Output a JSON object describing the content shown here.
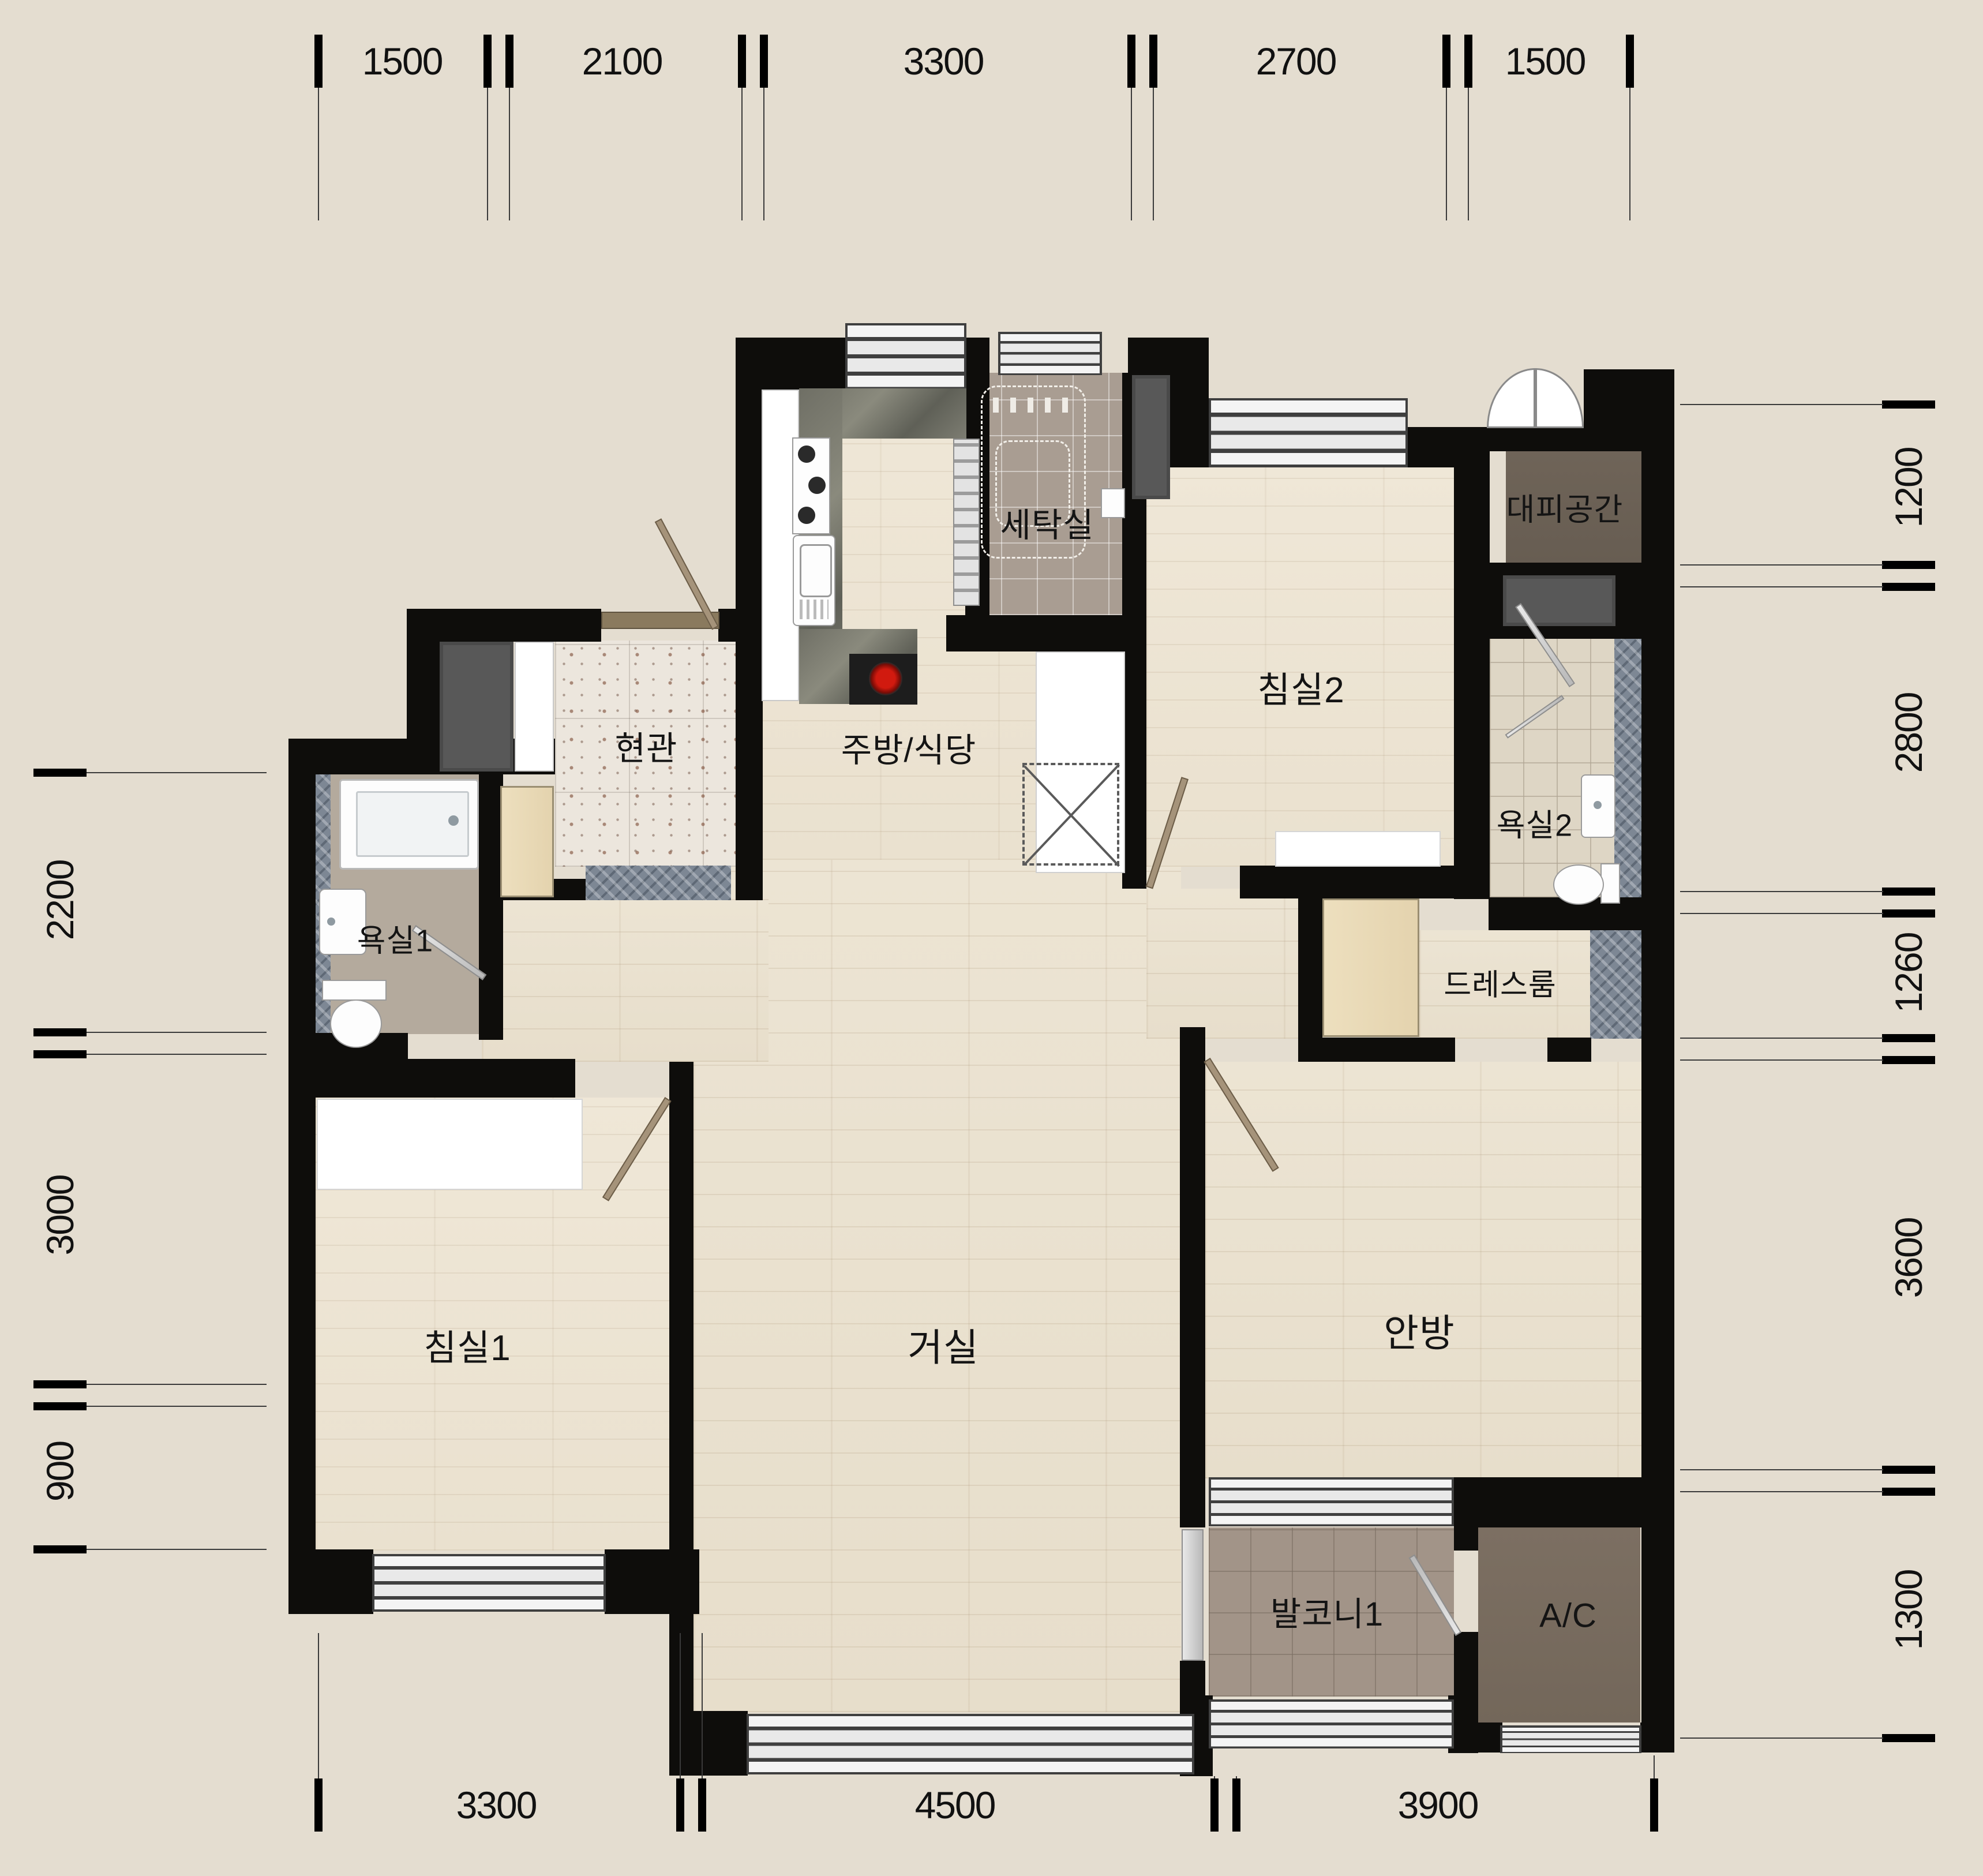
{
  "plan": {
    "type": "korean-apartment-floor-plan",
    "rooms": {
      "laundry": "세탁실",
      "shelter": "대피공간",
      "bedroom2": "침실2",
      "bath2": "욕실2",
      "entrance": "현관",
      "kitchen": "주방/식당",
      "bath1": "욕실1",
      "dressroom": "드레스룸",
      "bedroom1": "침실1",
      "living": "거실",
      "master": "안방",
      "balcony1": "발코니1",
      "ac": "A/C"
    },
    "dimensions": {
      "top": [
        "1500",
        "2100",
        "3300",
        "2700",
        "1500"
      ],
      "right": [
        "1200",
        "2800",
        "1260",
        "3600",
        "1300"
      ],
      "left": [
        "2200",
        "3000",
        "900"
      ],
      "bottom": [
        "3300",
        "4500",
        "3900"
      ]
    },
    "colors": {
      "background": "#e4ddd0",
      "wall": "#0e0d0b",
      "wood_floor": "#eae2d1",
      "laundry_tile": "#a99d92",
      "bath1_tile": "#b4aa9d",
      "bath2_tile": "#ded6c5",
      "balcony_tile": "#a29488",
      "shelter_floor": "#6f6458",
      "ac_floor": "#7c6f62",
      "closet": "#585858",
      "entry_granite": "#ece6dd",
      "threshold_marble": "#7d8794"
    }
  }
}
